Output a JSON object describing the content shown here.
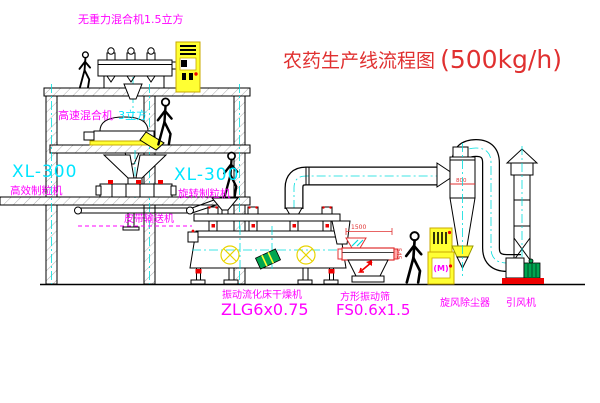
{
  "title": {
    "name": "农药生产线流程图",
    "capacity": "(500kg/h)"
  },
  "labels": {
    "mixer_top": "无重力混合机1.5立方",
    "mixer_speed": "高速混合机",
    "mixer_speed_vol": "3立方",
    "granulator_left_model": "XL-300",
    "granulator_left_name": "高效制粒机",
    "granulator_center_model": "XL-300",
    "granulator_center_name": "旋转制粒机",
    "belt_conveyor": "皮带输送机",
    "dryer_name": "振动流化床干燥机",
    "dryer_model": "ZLG6x0.75",
    "sieve_name": "方形振动筛",
    "sieve_model": "FS0.6x1.5",
    "cyclone_name": "旋风除尘器",
    "fan_name": "引风机",
    "cabinet_motor_symbol": "(M)"
  },
  "dimensions": {
    "sieve_length": "1500",
    "sieve_height": "545",
    "cyclone_dia": "800"
  },
  "colors": {
    "label_magenta": "#ff00ff",
    "model_cyan": "#00e5ff",
    "title_red": "#e03030",
    "equipment_yellow": "#ffff33",
    "line_black": "#000000",
    "centerline_cyan": "#00dddd",
    "motor_green": "#00a650",
    "base_red": "#ee0000"
  }
}
